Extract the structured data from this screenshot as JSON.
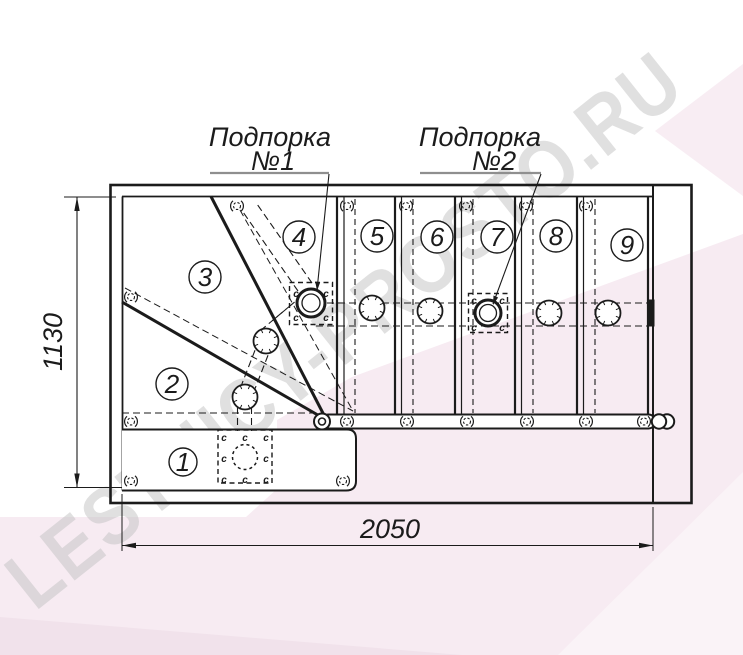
{
  "watermark": "LESTNICY-PROSTO.RU",
  "supports": [
    {
      "name": "Подпорка",
      "number": "№1"
    },
    {
      "name": "Подпорка",
      "number": "№2"
    }
  ],
  "dimensions": {
    "width_mm": "2050",
    "height_mm": "1130"
  },
  "treads": [
    "1",
    "2",
    "3",
    "4",
    "5",
    "6",
    "7",
    "8",
    "9"
  ],
  "mark": "c",
  "colors": {
    "line": "#1b1b1b",
    "pink_main": "#f7ebf2",
    "pink_corner": "#f8edf3",
    "pink_dark": "#f1e2eb",
    "pink_light": "#faf3f7",
    "watermark": "#c3c3c3",
    "underline": "#8f8f8f"
  }
}
